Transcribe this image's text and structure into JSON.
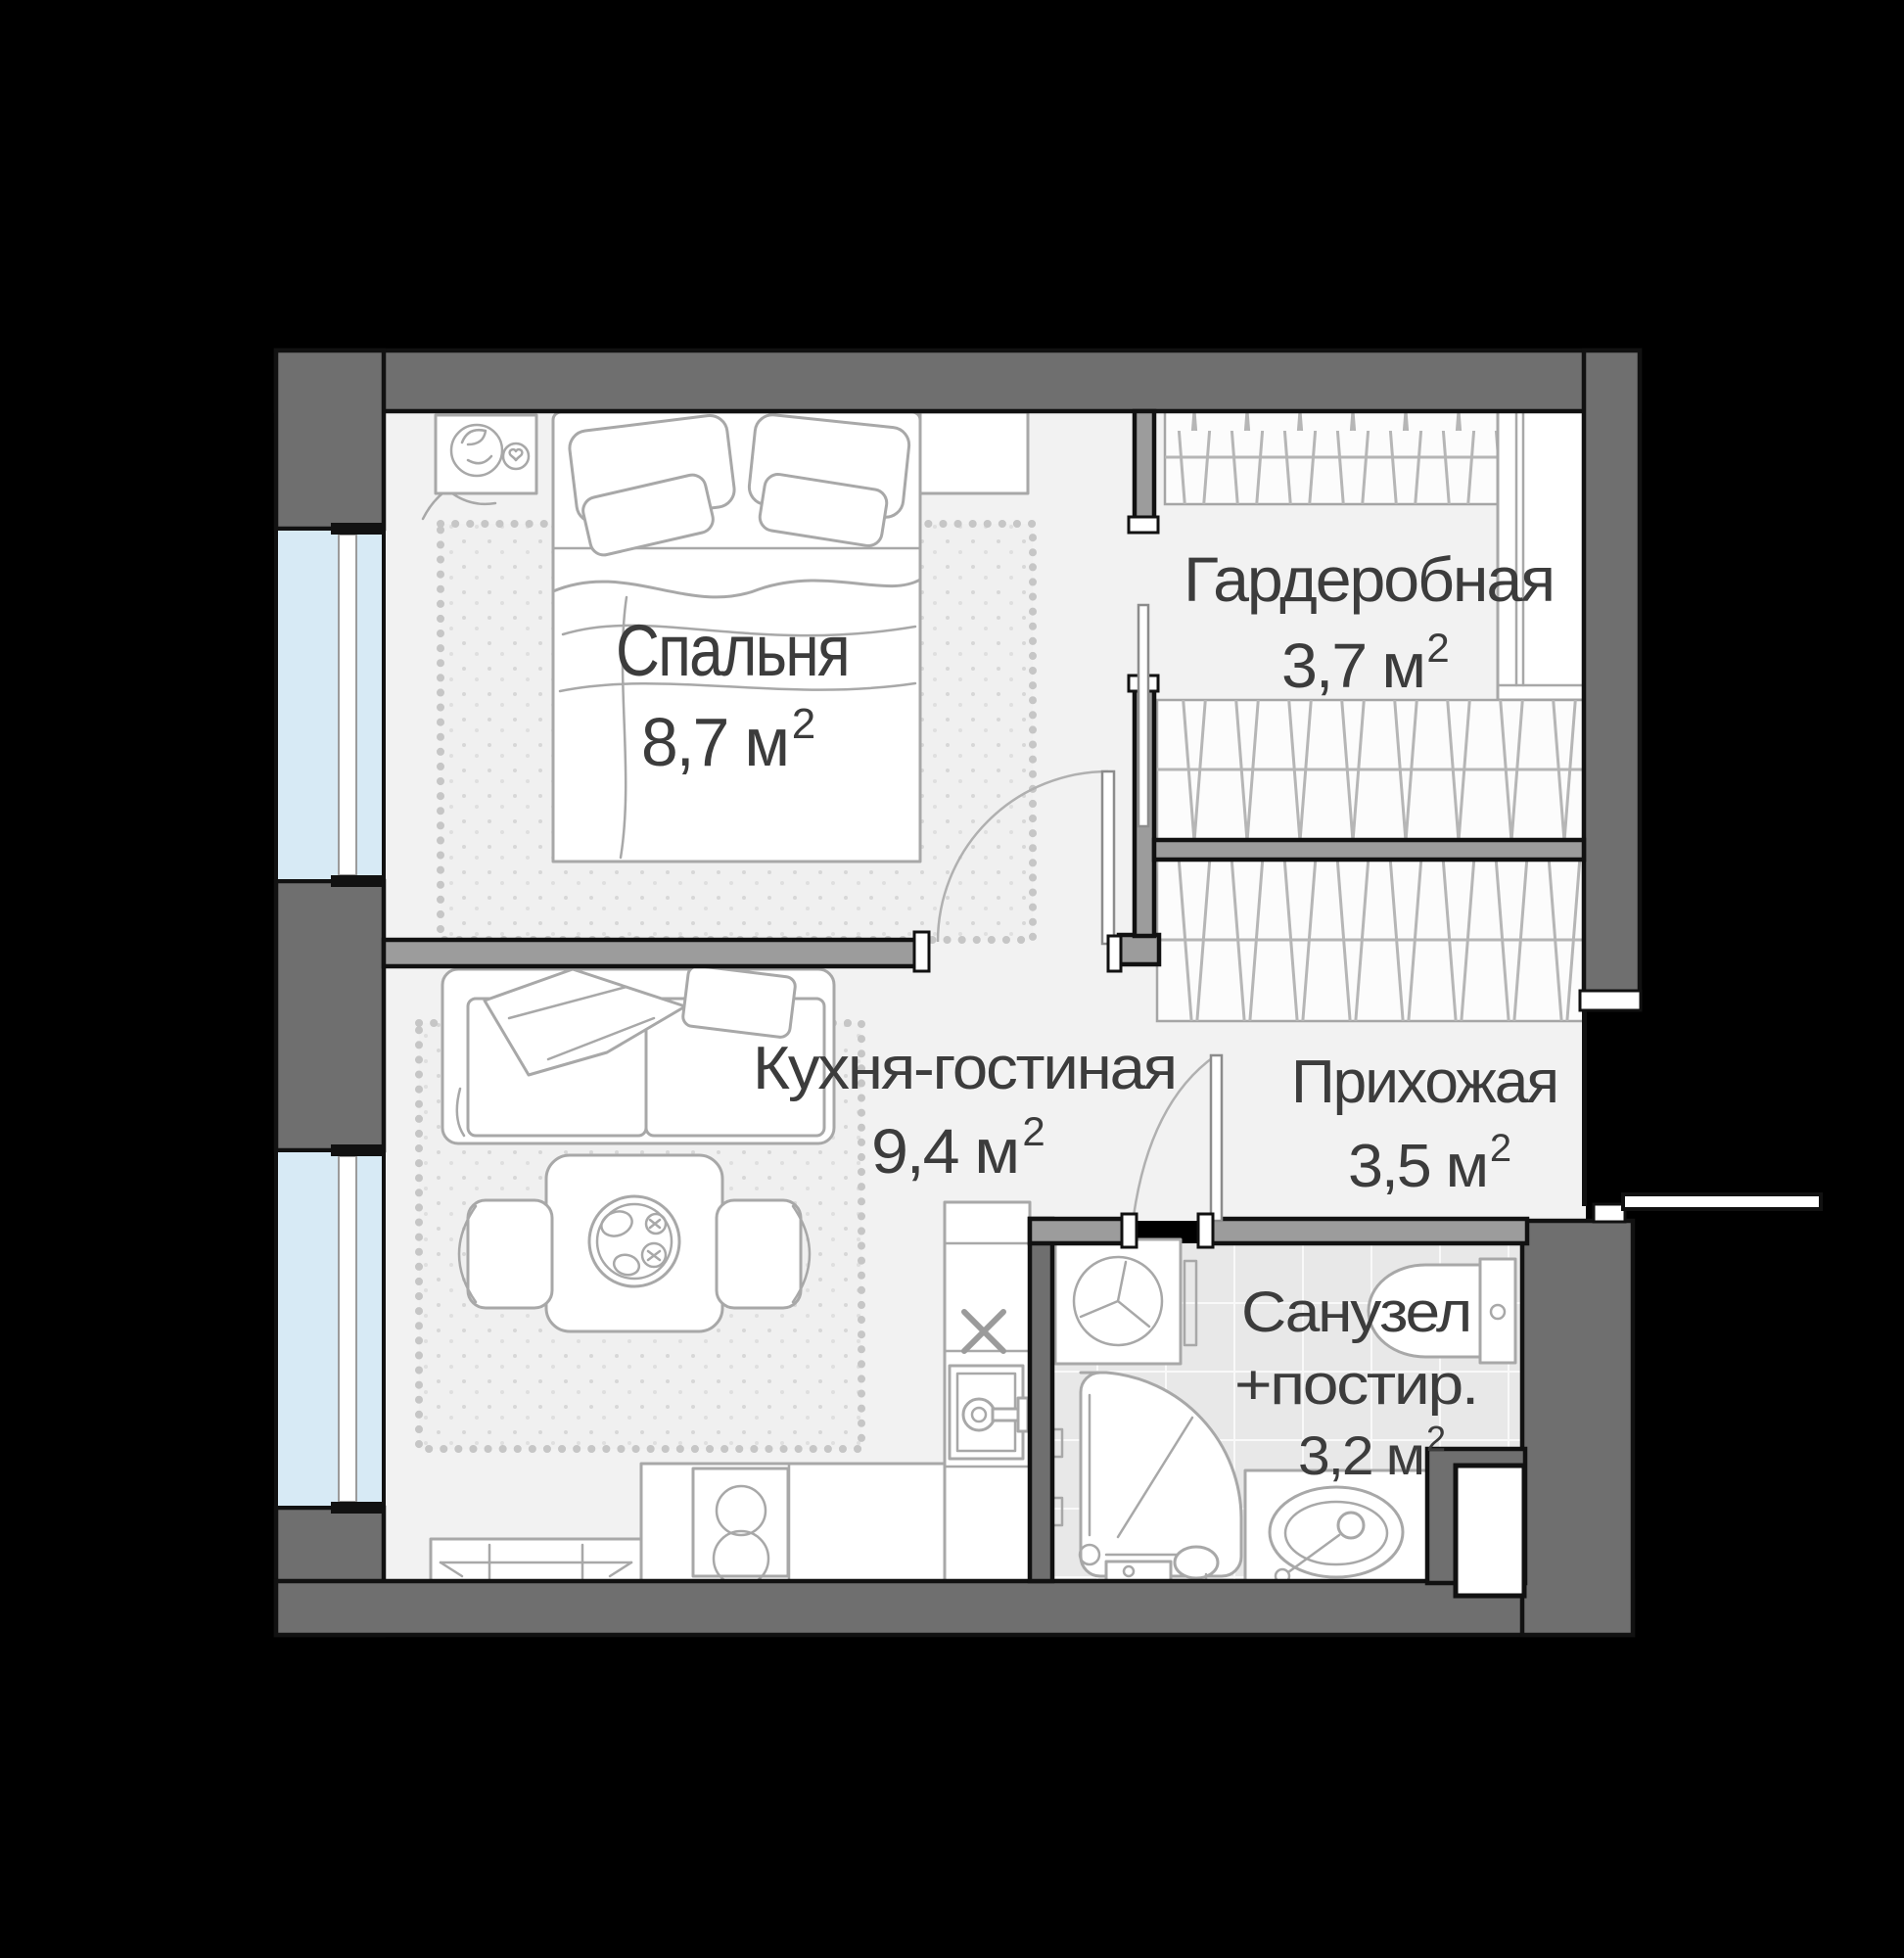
{
  "plan": {
    "kind": "apartment floor plan",
    "language": "ru",
    "rooms": [
      {
        "id": "bedroom",
        "name": "Спальня",
        "area_label": "8,7 м",
        "area_sup": "2"
      },
      {
        "id": "wardrobe",
        "name": "Гардеробная",
        "area_label": "3,7 м",
        "area_sup": "2"
      },
      {
        "id": "kitchen",
        "name": "Кухня-гостиная",
        "area_label": "9,4 м",
        "area_sup": "2"
      },
      {
        "id": "hallway",
        "name": "Прихожая",
        "area_label": "3,5 м",
        "area_sup": "2"
      },
      {
        "id": "bathroom",
        "name_line1": "Санузел",
        "name_line2": "+постир.",
        "area_label": "3,2 м",
        "area_sup": "2"
      }
    ],
    "colors": {
      "background": "#000000",
      "outer_wall": "#6f6f6f",
      "partition_wall": "#9c9c9c",
      "floor": "#f2f2f2",
      "window_glass": "#d7eaf5",
      "wall_outline": "#111111",
      "label_text": "#3c3c3c",
      "furniture_stroke": "#a8a8a8"
    }
  }
}
